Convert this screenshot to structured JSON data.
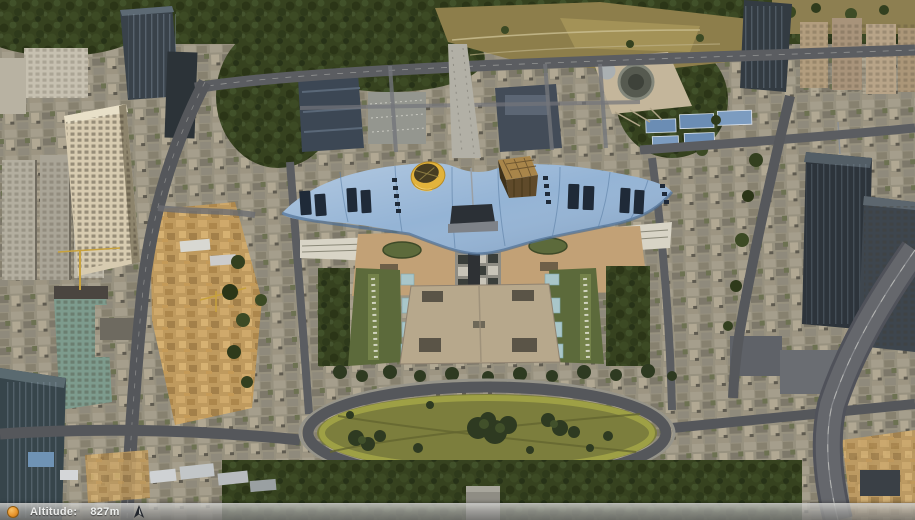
{
  "status_bar": {
    "altitude_label": "Altitude:",
    "altitude_value": "827m",
    "left_icon": "streaming-indicator-icon",
    "right_icon": "compass-arrow-icon"
  },
  "scene": {
    "colors": {
      "roof_blue": "#92b2d4",
      "cone_yellow": "#e2b33c",
      "cube_brown": "#a8854a",
      "plaza_tan": "#b7a88c",
      "podium_tan": "#c2a176",
      "lawn_olive": "#7c7e3d",
      "lawn_ring": "#a2a446",
      "hill_tan": "#8d7e4b",
      "park_green": "#36421f",
      "road_gray": "#55575b",
      "dirt_tan": "#bf9a5e",
      "status_orange": "#e8962e"
    }
  }
}
